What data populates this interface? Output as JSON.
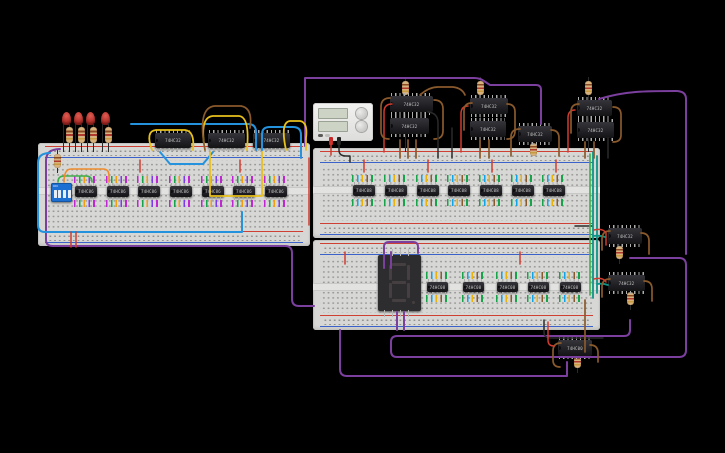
{
  "canvas": {
    "width": 725,
    "height": 453,
    "background": "#000000"
  },
  "palette": {
    "purple": "#7b3f9e",
    "blue": "#2492dc",
    "yellow": "#e8c11c",
    "green": "#3faf4a",
    "orange": "#ef8b2c",
    "red": "#d23b2f",
    "black": "#2b2b2b",
    "brown": "#8a5a2c",
    "teal": "#0d9488",
    "board": "#d7d7d5",
    "ic_body": "#1c1c20",
    "led_red": "#b5332c",
    "dip_blue": "#1d6fd1"
  },
  "breadboards": [
    {
      "x": 38,
      "y": 143,
      "w": 272,
      "h": 103,
      "channel": 48
    },
    {
      "x": 313,
      "y": 148,
      "w": 287,
      "h": 90,
      "channel": 42
    },
    {
      "x": 313,
      "y": 240,
      "w": 287,
      "h": 90,
      "channel": 47
    }
  ],
  "power_supply": {
    "x": 313,
    "y": 103,
    "w": 60,
    "h": 38
  },
  "dip_switch": {
    "x": 51,
    "y": 183,
    "w": 21,
    "h": 19,
    "label": "ON",
    "positions": 4
  },
  "seven_segment": {
    "x": 378,
    "y": 255,
    "w": 43,
    "h": 56,
    "digit": "8"
  },
  "leds": [
    {
      "x": 62,
      "y": 112
    },
    {
      "x": 74,
      "y": 112
    },
    {
      "x": 86,
      "y": 112
    },
    {
      "x": 101,
      "y": 112
    }
  ],
  "resistors": [
    {
      "x": 66,
      "y": 127,
      "h": 16
    },
    {
      "x": 78,
      "y": 127,
      "h": 16
    },
    {
      "x": 90,
      "y": 127,
      "h": 16
    },
    {
      "x": 105,
      "y": 127,
      "h": 16
    },
    {
      "x": 54,
      "y": 154,
      "h": 14
    },
    {
      "x": 402,
      "y": 81,
      "h": 14
    },
    {
      "x": 477,
      "y": 81,
      "h": 14
    },
    {
      "x": 585,
      "y": 81,
      "h": 14
    },
    {
      "x": 530,
      "y": 143,
      "h": 13
    },
    {
      "x": 616,
      "y": 246,
      "h": 13
    },
    {
      "x": 627,
      "y": 292,
      "h": 13
    },
    {
      "x": 574,
      "y": 355,
      "h": 13
    }
  ],
  "ics": [
    {
      "x": 155,
      "y": 133,
      "w": 36,
      "h": 15,
      "label": "74HC32",
      "fringe": null
    },
    {
      "x": 208,
      "y": 133,
      "w": 37,
      "h": 15,
      "label": "74HC32",
      "fringe": null
    },
    {
      "x": 253,
      "y": 133,
      "w": 37,
      "h": 15,
      "label": "74HC32",
      "fringe": null
    },
    {
      "x": 75,
      "y": 186,
      "w": 22,
      "h": 11,
      "label": "74HC86",
      "fringe": "warm"
    },
    {
      "x": 107,
      "y": 186,
      "w": 22,
      "h": 11,
      "label": "74HC86",
      "fringe": "warm"
    },
    {
      "x": 138,
      "y": 186,
      "w": 22,
      "h": 11,
      "label": "74HC86",
      "fringe": "warm"
    },
    {
      "x": 170,
      "y": 186,
      "w": 22,
      "h": 11,
      "label": "74HC86",
      "fringe": "warm"
    },
    {
      "x": 202,
      "y": 186,
      "w": 22,
      "h": 11,
      "label": "74HC86",
      "fringe": "warm"
    },
    {
      "x": 233,
      "y": 186,
      "w": 22,
      "h": 11,
      "label": "74HC86",
      "fringe": "warm"
    },
    {
      "x": 265,
      "y": 186,
      "w": 22,
      "h": 11,
      "label": "74HC86",
      "fringe": "warm"
    },
    {
      "x": 353,
      "y": 185,
      "w": 22,
      "h": 11,
      "label": "74HC08",
      "fringe": "cool"
    },
    {
      "x": 385,
      "y": 185,
      "w": 22,
      "h": 11,
      "label": "74HC08",
      "fringe": "cool"
    },
    {
      "x": 417,
      "y": 185,
      "w": 22,
      "h": 11,
      "label": "74HC08",
      "fringe": "cool"
    },
    {
      "x": 448,
      "y": 185,
      "w": 22,
      "h": 11,
      "label": "74HC08",
      "fringe": "cool"
    },
    {
      "x": 480,
      "y": 185,
      "w": 22,
      "h": 11,
      "label": "74HC08",
      "fringe": "cool"
    },
    {
      "x": 512,
      "y": 185,
      "w": 22,
      "h": 11,
      "label": "74HC08",
      "fringe": "cool"
    },
    {
      "x": 543,
      "y": 185,
      "w": 22,
      "h": 11,
      "label": "74HC08",
      "fringe": "cool"
    },
    {
      "x": 427,
      "y": 282,
      "w": 21,
      "h": 10,
      "label": "74HC08",
      "fringe": "cool"
    },
    {
      "x": 463,
      "y": 282,
      "w": 21,
      "h": 10,
      "label": "74HC08",
      "fringe": "cool"
    },
    {
      "x": 497,
      "y": 282,
      "w": 21,
      "h": 10,
      "label": "74HC08",
      "fringe": "cool"
    },
    {
      "x": 528,
      "y": 282,
      "w": 21,
      "h": 10,
      "label": "74HC08",
      "fringe": "cool"
    },
    {
      "x": 560,
      "y": 282,
      "w": 21,
      "h": 10,
      "label": "74HC08",
      "fringe": "cool"
    },
    {
      "x": 390,
      "y": 96,
      "w": 43,
      "h": 16,
      "label": "74HC32",
      "fringe": null
    },
    {
      "x": 390,
      "y": 118,
      "w": 39,
      "h": 16,
      "label": "74HC32",
      "fringe": null
    },
    {
      "x": 470,
      "y": 98,
      "w": 38,
      "h": 16,
      "label": "74HC32",
      "fringe": null
    },
    {
      "x": 470,
      "y": 121,
      "w": 36,
      "h": 16,
      "label": "74HC32",
      "fringe": null
    },
    {
      "x": 518,
      "y": 126,
      "w": 34,
      "h": 16,
      "label": "74HC32",
      "fringe": null
    },
    {
      "x": 577,
      "y": 100,
      "w": 35,
      "h": 16,
      "label": "74HC32",
      "fringe": null
    },
    {
      "x": 577,
      "y": 122,
      "w": 37,
      "h": 16,
      "label": "74HC32",
      "fringe": null
    },
    {
      "x": 608,
      "y": 228,
      "w": 34,
      "h": 16,
      "label": "74HC32",
      "fringe": null
    },
    {
      "x": 608,
      "y": 275,
      "w": 37,
      "h": 16,
      "label": "74HC32",
      "fringe": null
    },
    {
      "x": 558,
      "y": 340,
      "w": 34,
      "h": 16,
      "label": "74HC00",
      "fringe": null
    }
  ],
  "wires": [
    {
      "c": "purple",
      "d": "M305,146 L305,78 L474,78 Q480,78 484,81 L490,85 L536,85 Q541,85 541,90 L541,124"
    },
    {
      "c": "purple",
      "d": "M599,99 C625,91 645,91 676,91 Q686,91 686,99 L686,254"
    },
    {
      "c": "purple",
      "d": "M630,258 L679,258 Q686,258 686,265 L686,350 Q686,357 679,357 L397,357 Q391,357 391,351 L391,342 Q391,336 397,336 L624,336 Q630,336 630,330 L630,320"
    },
    {
      "c": "purple",
      "d": "M60,149 Q46,149 46,161 L46,240 Q46,246 53,246 L285,246 Q292,246 292,253 L292,299 Q292,306 299,306 L314,306"
    },
    {
      "c": "purple",
      "d": "M340,330 L340,369 Q340,376 347,376 L567,376 L567,362"
    },
    {
      "c": "purple",
      "d": "M384,268 L384,247 Q384,242 389,242 L413,242 Q418,242 418,247 L418,253"
    },
    {
      "c": "purple",
      "d": "M391,268 L391,252"
    },
    {
      "c": "purple",
      "d": "M397,312 L397,330"
    },
    {
      "c": "purple",
      "d": "M404,312 L404,330"
    },
    {
      "c": "blue",
      "d": "M50,153 Q38,153 38,163 L38,225 Q38,232 45,232 L242,232 L242,212"
    },
    {
      "c": "blue",
      "d": "M131,124 L248,124 Q256,124 256,132 L256,150"
    },
    {
      "c": "blue",
      "d": "M262,150 L262,134 Q262,127 270,127 L293,127 Q301,127 301,135 L301,158"
    },
    {
      "c": "blue",
      "d": "M160,152 L170,164 L203,164 L213,152"
    },
    {
      "c": "yellow",
      "d": "M152,150 Q145,131 156,130 L185,130 Q195,131 193,150"
    },
    {
      "c": "yellow",
      "d": "M205,150 Q199,117 213,116 L239,116 Q250,117 247,150"
    },
    {
      "c": "yellow",
      "d": "M210,152 L210,196 L262,196 L262,152"
    },
    {
      "c": "yellow",
      "d": "M286,150 Q280,122 290,121 L300,121 Q308,122 306,138 L306,150"
    },
    {
      "c": "brown",
      "d": "M205,150 Q197,107 215,106 L241,106 Q253,108 250,128"
    },
    {
      "c": "green",
      "d": "M58,182 Q58,176 64,176 L86,176 Q92,176 92,182"
    },
    {
      "c": "orange",
      "d": "M64,182 Q64,169 71,169 L103,169 Q109,169 109,176 L109,182"
    },
    {
      "c": "red",
      "d": "M331,141 L331,155"
    },
    {
      "c": "black",
      "d": "M339,141 L339,150 Q339,156 346,156 L350,156 L350,162"
    },
    {
      "c": "red",
      "d": "M392,104 Q384,104 384,112 L384,152"
    },
    {
      "c": "red",
      "d": "M468,106 Q461,106 461,114 L461,152"
    },
    {
      "c": "red",
      "d": "M575,110 Q568,110 568,118 L568,152"
    },
    {
      "c": "red",
      "d": "M309,158 L309,225"
    },
    {
      "c": "brown",
      "d": "M390,98 Q381,98 381,107 L381,131 Q381,139 389,139"
    },
    {
      "c": "brown",
      "d": "M434,100 Q443,100 443,109 L443,131 Q443,139 434,139"
    },
    {
      "c": "brown",
      "d": "M400,140 L400,158"
    },
    {
      "c": "brown",
      "d": "M408,140 L408,158"
    },
    {
      "c": "brown",
      "d": "M416,140 L416,158"
    },
    {
      "c": "brown",
      "d": "M472,103 Q464,103 464,111 L464,130"
    },
    {
      "c": "brown",
      "d": "M507,104 Q515,104 515,112 L515,131 Q515,139 507,139"
    },
    {
      "c": "brown",
      "d": "M480,140 L480,158"
    },
    {
      "c": "brown",
      "d": "M489,140 L489,158"
    },
    {
      "c": "brown",
      "d": "M420,95 Q429,87 438,87 L453,87 Q462,88 465,95"
    },
    {
      "c": "brown",
      "d": "M520,129 Q511,129 511,137 L511,156"
    },
    {
      "c": "brown",
      "d": "M551,130 Q559,130 559,138 L559,156"
    },
    {
      "c": "brown",
      "d": "M579,104 Q571,104 571,112 L571,133"
    },
    {
      "c": "brown",
      "d": "M613,107 Q621,107 621,115 L621,135 Q621,142 613,142"
    },
    {
      "c": "brown",
      "d": "M585,142 L585,158"
    },
    {
      "c": "brown",
      "d": "M594,142 L594,158"
    },
    {
      "c": "black",
      "d": "M428,112 Q438,113 438,123 L438,158"
    },
    {
      "c": "black",
      "d": "M452,128 L452,158"
    },
    {
      "c": "black",
      "d": "M608,138 L608,158"
    },
    {
      "c": "black",
      "d": "M575,226 L592,226"
    },
    {
      "c": "black",
      "d": "M544,320 L544,332 Q544,338 551,338 L603,338"
    },
    {
      "c": "teal",
      "d": "M593,152 L593,298"
    },
    {
      "c": "teal",
      "d": "M597,156 L597,293"
    },
    {
      "c": "green",
      "d": "M590,154 L590,295"
    },
    {
      "c": "teal",
      "d": "M593,236 Q600,235 605,237"
    },
    {
      "c": "teal",
      "d": "M597,284 Q603,283 608,285"
    },
    {
      "c": "brown",
      "d": "M610,231 Q602,231 602,239 L602,250"
    },
    {
      "c": "brown",
      "d": "M641,233 Q649,233 649,241 L649,254"
    },
    {
      "c": "brown",
      "d": "M610,279 Q602,279 602,287 L602,297"
    },
    {
      "c": "brown",
      "d": "M644,281 Q652,281 652,289 L652,301"
    },
    {
      "c": "brown",
      "d": "M585,300 L585,352"
    },
    {
      "c": "brown",
      "d": "M561,343 Q553,343 553,351 L553,360 Q553,367 560,367"
    },
    {
      "c": "brown",
      "d": "M590,345 Q598,345 598,353 L598,362"
    },
    {
      "c": "red",
      "d": "M594,230 Q603,228 606,233 L606,245"
    },
    {
      "c": "red",
      "d": "M594,279 Q603,277 606,282"
    },
    {
      "c": "red",
      "d": "M548,322 L548,340 Q548,346 554,346"
    },
    {
      "c": "red",
      "d": "M71,232 L71,247"
    },
    {
      "c": "red",
      "d": "M76,232 L76,247"
    },
    {
      "c": "red",
      "d": "M140,160 L140,172"
    },
    {
      "c": "red",
      "d": "M240,160 L240,172"
    },
    {
      "c": "red",
      "d": "M364,160 L364,172"
    },
    {
      "c": "red",
      "d": "M428,160 L428,172"
    },
    {
      "c": "red",
      "d": "M492,160 L492,172"
    },
    {
      "c": "red",
      "d": "M556,160 L556,172"
    },
    {
      "c": "red",
      "d": "M345,252 L345,264"
    },
    {
      "c": "red",
      "d": "M520,252 L520,264"
    }
  ]
}
